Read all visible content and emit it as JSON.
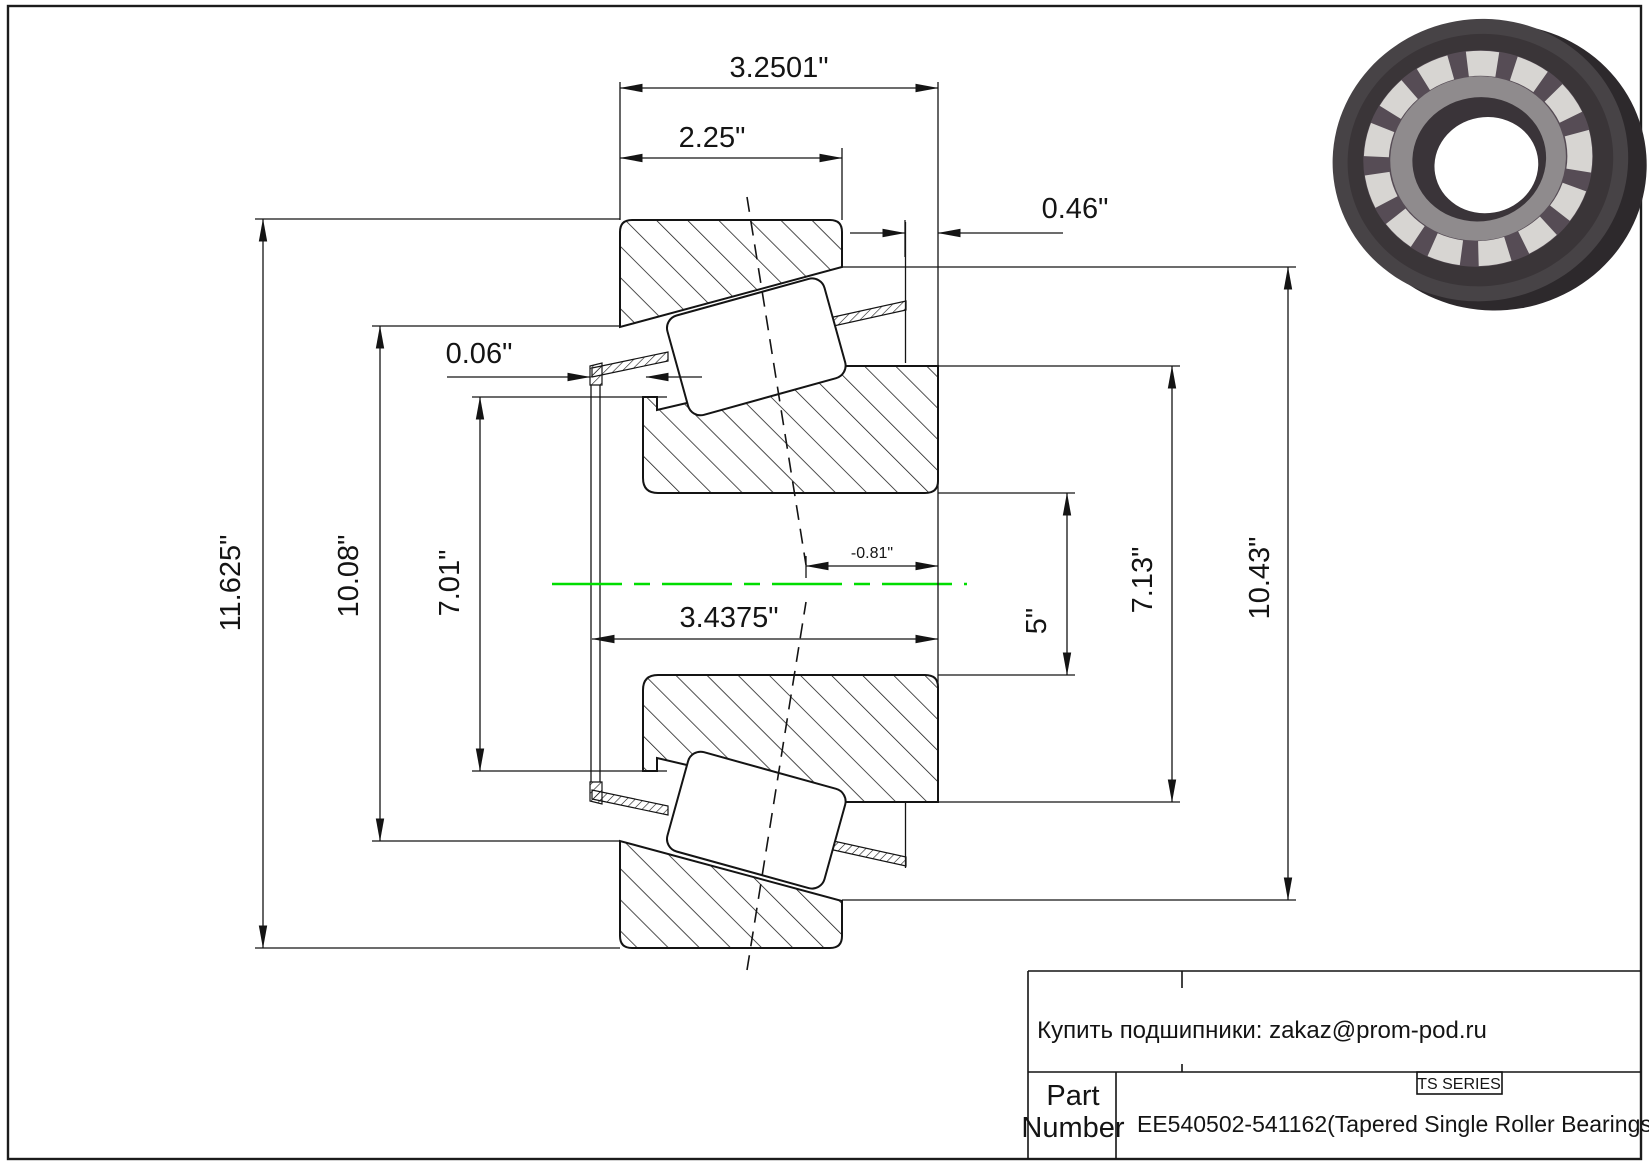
{
  "drawing": {
    "dims": {
      "overall_width": "3.2501\"",
      "cup_width": "2.25\"",
      "standout": "0.46\"",
      "cage_clearance": "0.06\"",
      "effective_center": "-0.81\"",
      "cone_width": "3.4375\"",
      "outer_diameter": "11.625\"",
      "cup_front_inner_diameter": "10.08\"",
      "cone_front_rib_diameter": "7.01\"",
      "bore_diameter": "5\"",
      "cone_back_rib_diameter": "7.13\"",
      "cup_back_inner_diameter": "10.43\""
    },
    "centerline_color": "#00dd00"
  },
  "title_block": {
    "contact": "Купить подшипники: zakaz@prom-pod.ru",
    "series": "TS SERIES",
    "part_label": [
      "Part",
      "Number"
    ],
    "part_number": "EE540502-541162(Tapered Single Roller Bearings)"
  }
}
